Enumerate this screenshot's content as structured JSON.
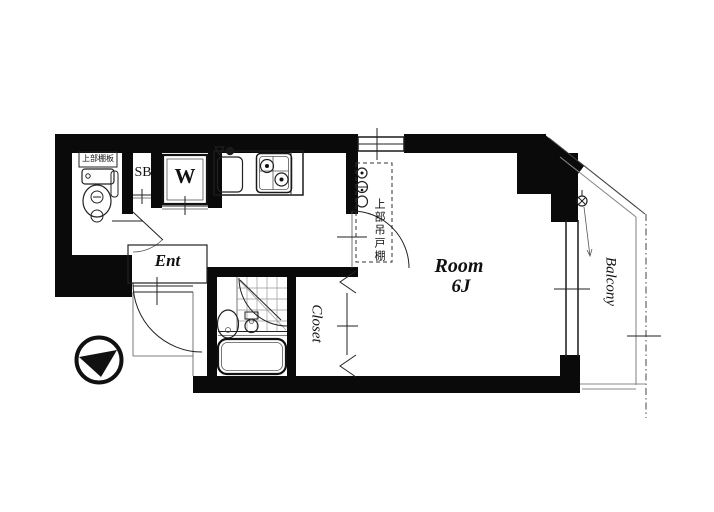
{
  "labels": {
    "room_name": "Room",
    "room_size": "6J",
    "entrance": "Ent",
    "closet": "Closet",
    "balcony": "Balcony",
    "washing_machine": "W",
    "shoe_box": "SB",
    "toilet_shelf": "上部棚板",
    "kitchen_upper_cabinet": "上部吊戸棚"
  },
  "colors": {
    "wall": "#0a0a0a",
    "thin_line": "#333333",
    "gray_line": "#8a8a8a"
  }
}
